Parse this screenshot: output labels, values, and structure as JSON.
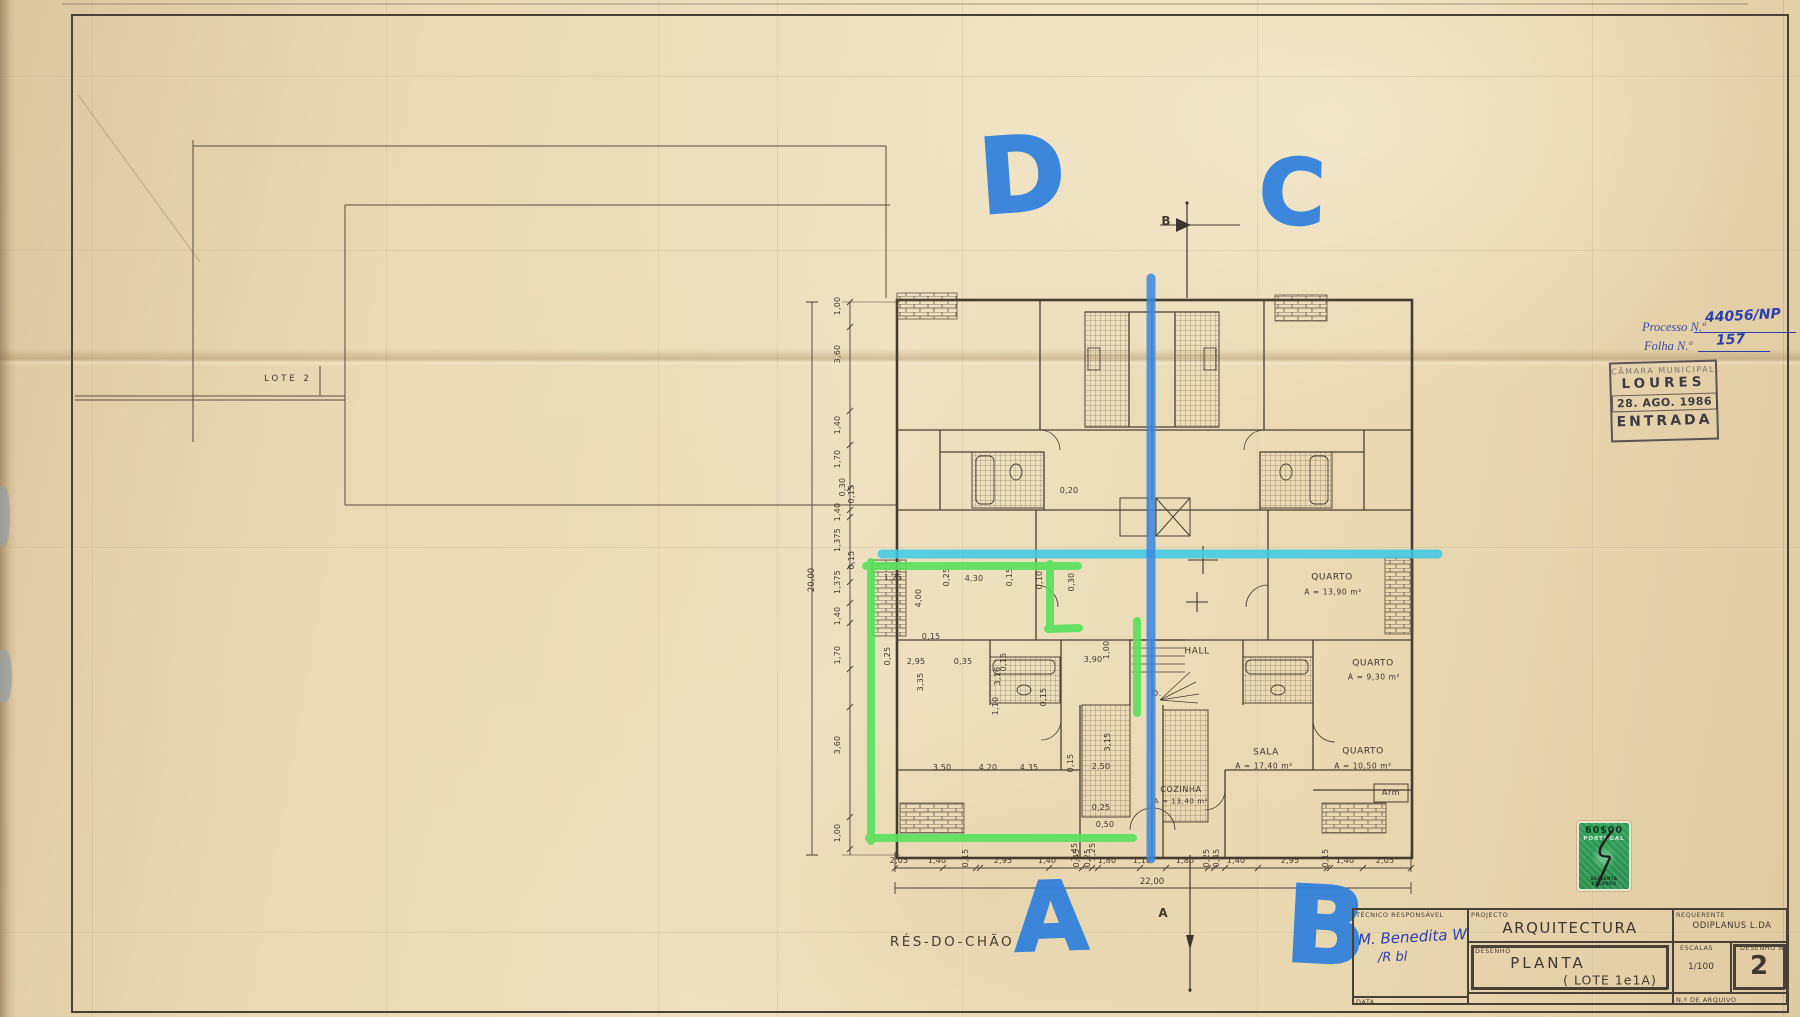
{
  "annotations": {
    "letters": [
      {
        "t": "D",
        "x": 1022,
        "y": 180,
        "size": 104,
        "rot": -4
      },
      {
        "t": "C",
        "x": 1292,
        "y": 198,
        "size": 90,
        "rot": 2
      },
      {
        "t": "A",
        "x": 1051,
        "y": 923,
        "size": 95,
        "rot": -2
      },
      {
        "t": "B",
        "x": 1326,
        "y": 932,
        "size": 106,
        "rot": 3
      }
    ],
    "colors": {
      "marker_blue": "#2f80dd",
      "marker_cyan": "#3cc9e8",
      "marker_green": "#58e05c",
      "pen_blue": "#2b3fae"
    }
  },
  "plan": {
    "floor_label": "RÉS-DO-CHÃO",
    "site_label": "LOTE 2",
    "section_marker_top": "B",
    "section_marker_bottom": "A",
    "total_width": "22,00",
    "total_height": "20,00",
    "room_labels": [
      {
        "t": "QUARTO",
        "x": 1332,
        "y": 578
      },
      {
        "t": "A = 13,90 m²",
        "x": 1333,
        "y": 592,
        "fs": 7.5
      },
      {
        "t": "QUARTO",
        "x": 1373,
        "y": 664
      },
      {
        "t": "A = 9,30 m²",
        "x": 1374,
        "y": 677,
        "fs": 7.5
      },
      {
        "t": "SALA",
        "x": 1266,
        "y": 753
      },
      {
        "t": "A = 17,40 m²",
        "x": 1264,
        "y": 766,
        "fs": 7.5
      },
      {
        "t": "QUARTO",
        "x": 1363,
        "y": 752
      },
      {
        "t": "A = 10,50 m²",
        "x": 1363,
        "y": 766,
        "fs": 7.5
      },
      {
        "t": "COZINHA",
        "x": 1181,
        "y": 790,
        "fs": 8
      },
      {
        "t": "A = 13,40 m²",
        "x": 1181,
        "y": 802,
        "fs": 7
      },
      {
        "t": "HALL",
        "x": 1197,
        "y": 652
      },
      {
        "t": "Arm",
        "x": 1391,
        "y": 793,
        "fs": 8
      },
      {
        "t": "D.",
        "x": 1157,
        "y": 694,
        "fs": 8
      }
    ],
    "dims_bottom": [
      {
        "t": "2,05",
        "x": 899,
        "y": 861
      },
      {
        "t": "1,40",
        "x": 937,
        "y": 861
      },
      {
        "t": "0,15",
        "x": 966,
        "y": 858,
        "r": 1
      },
      {
        "t": "2,95",
        "x": 1003,
        "y": 861
      },
      {
        "t": "1,40",
        "x": 1047,
        "y": 861
      },
      {
        "t": "0,45",
        "x": 1077,
        "y": 858,
        "r": 1
      },
      {
        "t": "0,25",
        "x": 1088,
        "y": 858,
        "r": 1
      },
      {
        "t": "1,80",
        "x": 1107,
        "y": 861
      },
      {
        "t": "1,10",
        "x": 1142,
        "y": 861
      },
      {
        "t": "1,80",
        "x": 1185,
        "y": 861
      },
      {
        "t": "0,25",
        "x": 1207,
        "y": 858,
        "r": 1
      },
      {
        "t": "0,45",
        "x": 1217,
        "y": 858,
        "r": 1
      },
      {
        "t": "1,40",
        "x": 1236,
        "y": 861
      },
      {
        "t": "2,95",
        "x": 1290,
        "y": 861
      },
      {
        "t": "0,15",
        "x": 1326,
        "y": 858,
        "r": 1
      },
      {
        "t": "1,40",
        "x": 1345,
        "y": 861
      },
      {
        "t": "2,05",
        "x": 1385,
        "y": 861
      }
    ],
    "dims_left": [
      {
        "t": "1,00",
        "x": 838,
        "y": 306,
        "r": 1
      },
      {
        "t": "3,60",
        "x": 838,
        "y": 354,
        "r": 1
      },
      {
        "t": "1,40",
        "x": 838,
        "y": 425,
        "r": 1
      },
      {
        "t": "1,70",
        "x": 838,
        "y": 459,
        "r": 1
      },
      {
        "t": "0,30",
        "x": 843,
        "y": 487,
        "r": 1
      },
      {
        "t": "0,15",
        "x": 852,
        "y": 494,
        "r": 1
      },
      {
        "t": "1,40",
        "x": 838,
        "y": 512,
        "r": 1
      },
      {
        "t": "1,375",
        "x": 838,
        "y": 540,
        "r": 1
      },
      {
        "t": "0,15",
        "x": 852,
        "y": 560,
        "r": 1
      },
      {
        "t": "1,375",
        "x": 838,
        "y": 582,
        "r": 1
      },
      {
        "t": "1,40",
        "x": 838,
        "y": 616,
        "r": 1
      },
      {
        "t": "1,70",
        "x": 838,
        "y": 655,
        "r": 1
      },
      {
        "t": "3,60",
        "x": 838,
        "y": 745,
        "r": 1
      },
      {
        "t": "1,00",
        "x": 838,
        "y": 833,
        "r": 1
      }
    ],
    "dims_interior": [
      {
        "t": "1,25",
        "x": 893,
        "y": 578
      },
      {
        "t": "0,25",
        "x": 947,
        "y": 577,
        "r": 1
      },
      {
        "t": "4,30",
        "x": 974,
        "y": 579
      },
      {
        "t": "0,15",
        "x": 1010,
        "y": 577,
        "r": 1
      },
      {
        "t": "0,10",
        "x": 1040,
        "y": 580,
        "r": 1
      },
      {
        "t": "0,30",
        "x": 1072,
        "y": 582,
        "r": 1
      },
      {
        "t": "4,00",
        "x": 919,
        "y": 598,
        "r": 1
      },
      {
        "t": "0,15",
        "x": 931,
        "y": 637
      },
      {
        "t": "0,25",
        "x": 888,
        "y": 656,
        "r": 1
      },
      {
        "t": "2,95",
        "x": 916,
        "y": 662
      },
      {
        "t": "3,35",
        "x": 921,
        "y": 682,
        "r": 1
      },
      {
        "t": "0,35",
        "x": 963,
        "y": 662
      },
      {
        "t": "0,15",
        "x": 1004,
        "y": 662,
        "r": 1
      },
      {
        "t": "3,16",
        "x": 998,
        "y": 676,
        "r": 1
      },
      {
        "t": "3,90",
        "x": 1093,
        "y": 660
      },
      {
        "t": "1,00",
        "x": 1107,
        "y": 650,
        "r": 1
      },
      {
        "t": "0,20",
        "x": 1069,
        "y": 491
      },
      {
        "t": "0,15",
        "x": 1044,
        "y": 697,
        "r": 1
      },
      {
        "t": "1,10",
        "x": 996,
        "y": 706,
        "r": 1
      },
      {
        "t": "3,50",
        "x": 942,
        "y": 768
      },
      {
        "t": "4,20",
        "x": 988,
        "y": 768
      },
      {
        "t": "4,35",
        "x": 1029,
        "y": 768
      },
      {
        "t": "0,15",
        "x": 1071,
        "y": 763,
        "r": 1
      },
      {
        "t": "2,50",
        "x": 1101,
        "y": 767
      },
      {
        "t": "3,15",
        "x": 1108,
        "y": 742,
        "r": 1
      },
      {
        "t": "0,25",
        "x": 1101,
        "y": 808
      },
      {
        "t": "0,50",
        "x": 1105,
        "y": 825
      },
      {
        "t": "1,45",
        "x": 1075,
        "y": 852,
        "r": 1
      },
      {
        "t": "1,25",
        "x": 1093,
        "y": 852,
        "r": 1
      }
    ]
  },
  "stamps": {
    "processo_label": "Processo N.º",
    "processo_value": "44056/NP",
    "folha_label": "Folha N.º",
    "folha_value": "157",
    "municipal": {
      "line1": "CÂMARA MUNICIPAL,",
      "line2": "LOURES",
      "date": "28. AGO. 1986",
      "line4": "ENTRADA"
    },
    "fiscal": {
      "value": "60$00",
      "country": "PORTUGAL",
      "denomination": "SESSENTA ESCUDOS"
    }
  },
  "title_block": {
    "tecnico_label": "TÉCNICO RESPONSÁVEL",
    "data_label": "DATA",
    "projecto_label": "PROJECTO",
    "projecto_value": "ARQUITECTURA",
    "desenho_label": "DESENHO",
    "desenho_value": "PLANTA",
    "desenho_value2": "( LOTE 1e1A)",
    "requerente_label": "REQUERENTE",
    "requerente_value": "ODIPLANUS  L.DA",
    "escalas_label": "ESCALAS",
    "escalas_value": "1/100",
    "desenho_n_label": "DESENHO N.",
    "desenho_n_value": "2",
    "arquivo_label": "N.º DE ARQUIVO",
    "signature_line1": "M. Benedita W",
    "signature_line2": "/R bl"
  }
}
